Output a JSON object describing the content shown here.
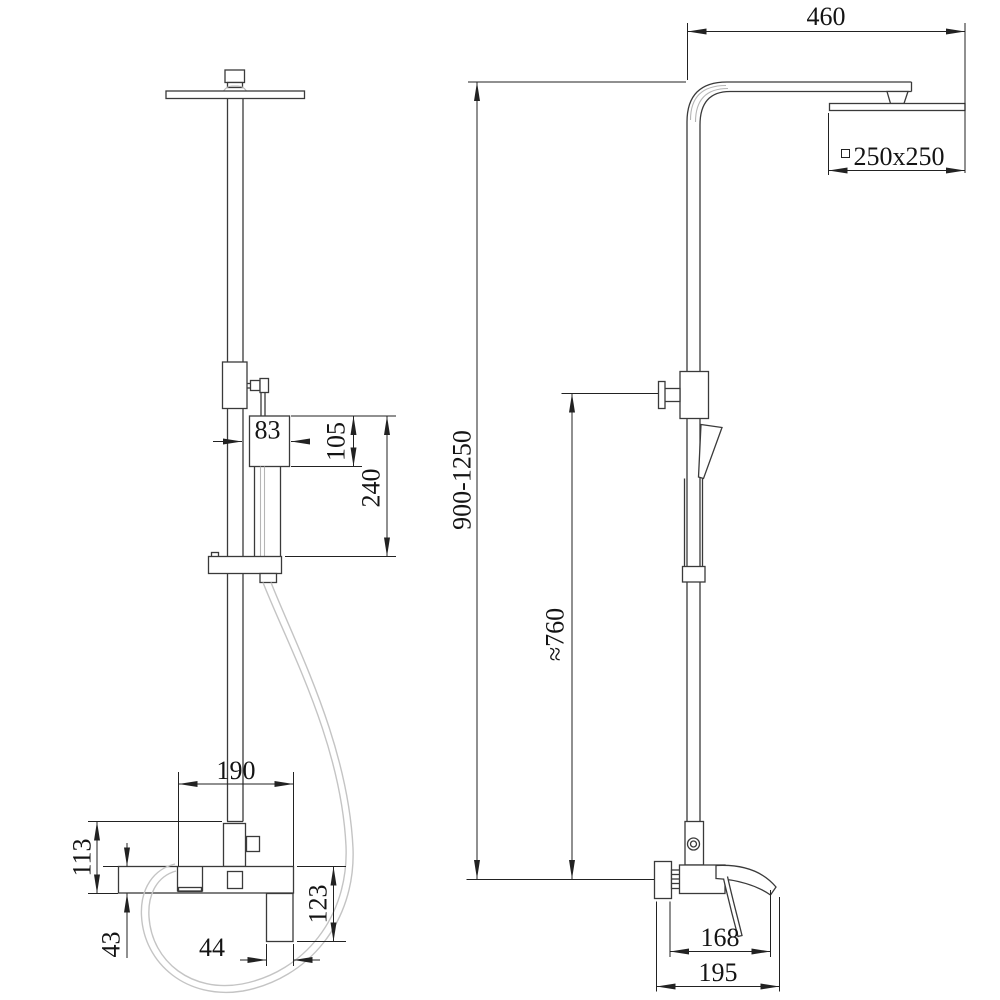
{
  "drawing": {
    "kind": "shower-column-dimension-drawing",
    "colors": {
      "background": "#ffffff",
      "object_line": "#3a3a3a",
      "dimension_line": "#222222",
      "hose_line": "#c4c4c4",
      "text": "#141414"
    },
    "dimensions": {
      "arm_reach": "460",
      "head_size": "250x250",
      "height_range": "900-1250",
      "slide_bar_height": "≈760",
      "hand_shower_width": "83",
      "hand_shower_head_height": "105",
      "hand_shower_length": "240",
      "mixer_width": "190",
      "mixer_body_height": "113",
      "spout_height": "43",
      "handle_width": "44",
      "handle_drop": "123",
      "spout_reach": "168",
      "mixer_depth": "195"
    }
  }
}
